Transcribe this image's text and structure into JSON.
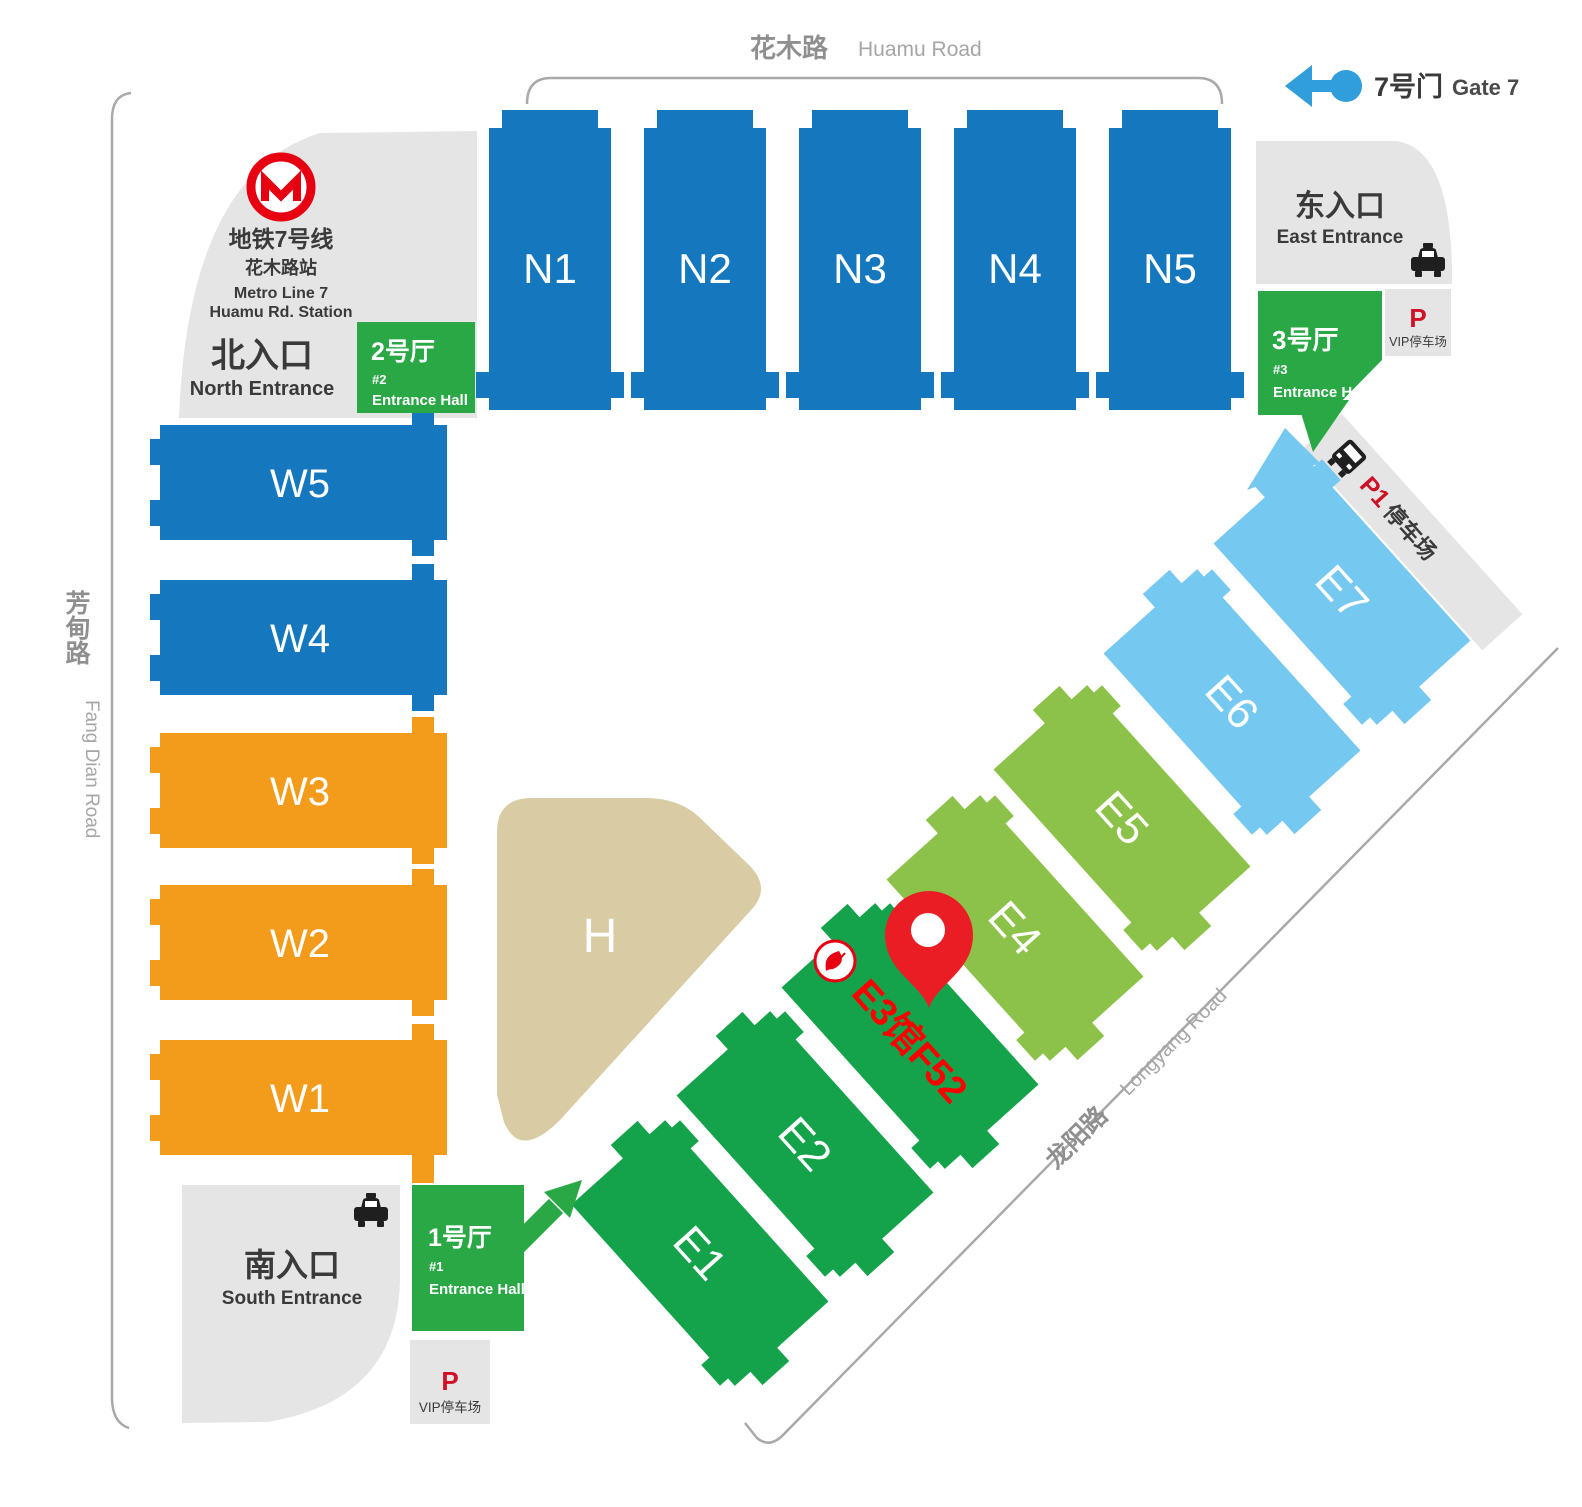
{
  "roads": {
    "huamu_cn": "花木路",
    "huamu_en": "Huamu Road",
    "fangdian_cn": "芳甸路",
    "fangdian_en": "Fang Dian Road",
    "longyang_cn": "龙阳路",
    "longyang_en": "Longyang Road"
  },
  "legend": {
    "gate7_cn": "7号门",
    "gate7_en": "Gate 7"
  },
  "metro": {
    "line_cn": "地铁7号线",
    "station_cn": "花木路站",
    "line_en": "Metro Line 7",
    "station_en": "Huamu Rd. Station"
  },
  "entrances": {
    "north_cn": "北入口",
    "north_en": "North Entrance",
    "east_cn": "东入口",
    "east_en": "East Entrance",
    "south_cn": "南入口",
    "south_en": "South Entrance"
  },
  "entrance_halls": {
    "hall1": {
      "cn": "1号厅",
      "num": "#1",
      "en": "Entrance Hall"
    },
    "hall2": {
      "cn": "2号厅",
      "num": "#2",
      "en": "Entrance Hall"
    },
    "hall3": {
      "cn": "3号厅",
      "num": "#3",
      "en": "Entrance Hall"
    }
  },
  "parking": {
    "p": "P",
    "vip": "VIP停车场",
    "p1": "P1",
    "p1_suffix": "停车场"
  },
  "halls": {
    "north": [
      "N1",
      "N2",
      "N3",
      "N4",
      "N5"
    ],
    "west": [
      "W5",
      "W4",
      "W3",
      "W2",
      "W1"
    ],
    "east": [
      "E1",
      "E2",
      "E3",
      "E4",
      "E5",
      "E6",
      "E7"
    ],
    "h": "H"
  },
  "marker": {
    "booth": "E3馆F52"
  },
  "colors": {
    "hall_blue": "#1577be",
    "hall_orange": "#f39c1b",
    "hall_green": "#14a24b",
    "hall_light_green": "#8cc249",
    "hall_light_blue": "#75c8ef",
    "hall_beige": "#d9cba4",
    "entrance_hall_green": "#2aa845",
    "entrance_gray": "#e5e5e5",
    "road_line": "#a9a9a9",
    "road_text": "#8f8f8f",
    "dark_text": "#3a3a3a",
    "accent_red": "#e60012",
    "parking_p_red": "#cf1126",
    "pin_red": "#ea1d25",
    "marker_text_red": "#ff0000",
    "gate7_blue": "#2f9edb"
  }
}
